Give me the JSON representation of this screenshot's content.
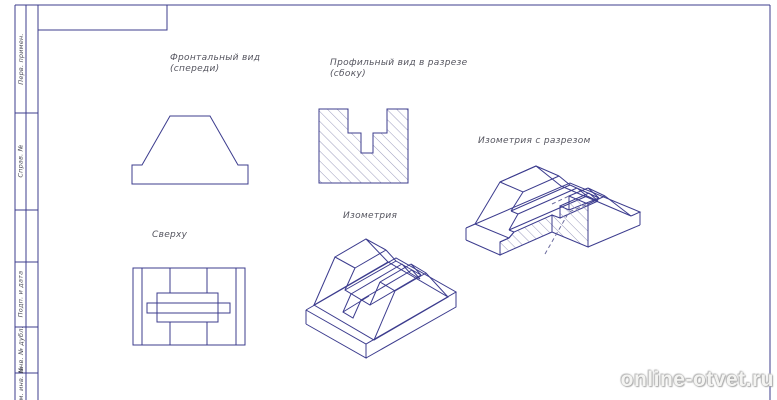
{
  "sheet": {
    "colors": {
      "frame": "#3c3c8e",
      "line": "#3c3c8e",
      "hatch": "#9b9bbd",
      "label_text": "#55555f"
    },
    "labels": {
      "front_line1": "Фронтальный вид",
      "front_line2": "(спереди)",
      "profile_line1": "Профильный вид в разрезе",
      "profile_line2": "(сбоку)",
      "top": "Сверху",
      "iso": "Изометрия",
      "iso_cut": "Изометрия с разрезом"
    },
    "margin_stamps": [
      "Перв. примен.",
      "Справ. №",
      "Подп. и дата",
      "Инв. № дубл.",
      "Взам. инв. №"
    ]
  },
  "watermark": {
    "text": "online-otvet.ru"
  }
}
